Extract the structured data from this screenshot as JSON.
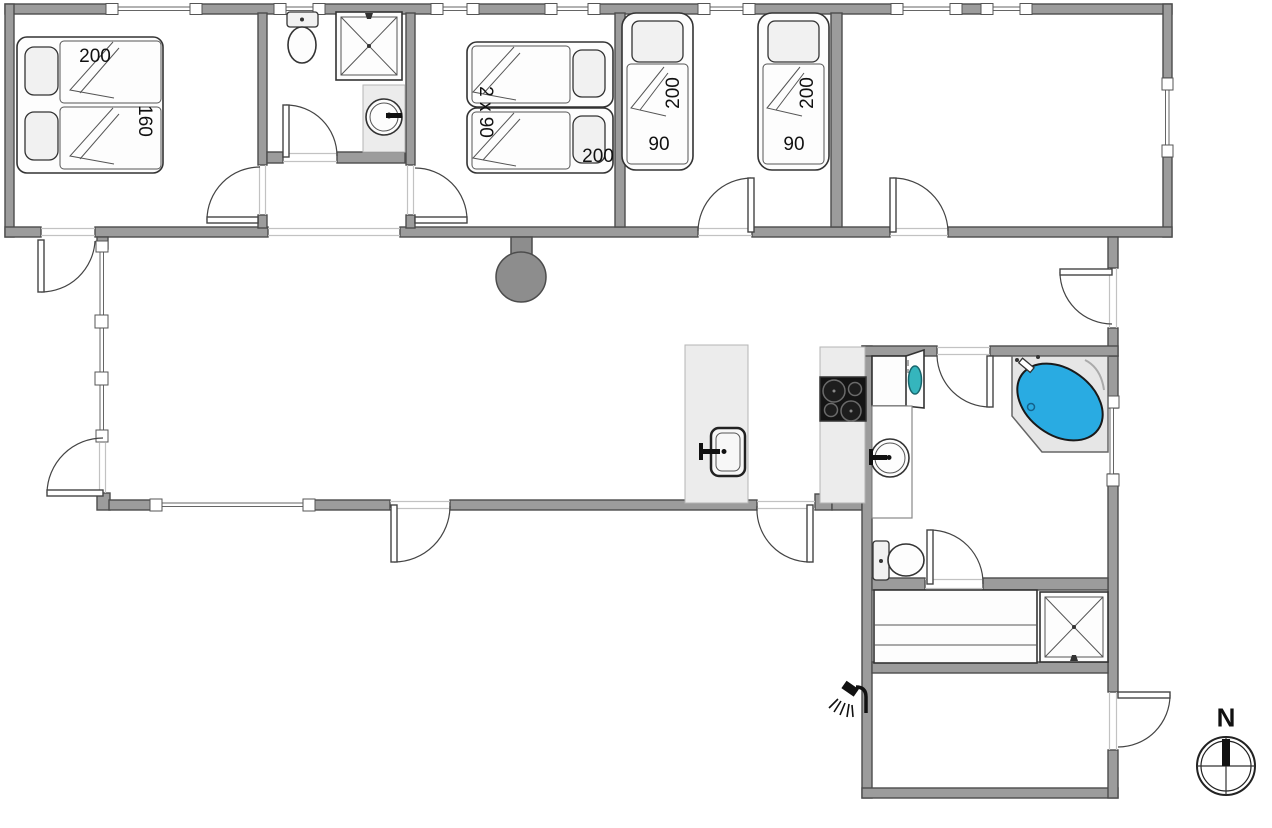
{
  "plan": {
    "type": "holiday-house-floor-plan",
    "labels": {
      "bed_double_length": "200",
      "bed_double_width": "160",
      "bed_twin_type": "2 x 90",
      "bed_twin_length": "200",
      "single_bed_a_length": "200",
      "single_bed_a_width": "90",
      "single_bed_b_length": "200",
      "single_bed_b_width": "90",
      "compass_north": "N"
    },
    "colors": {
      "wall": "#9c9c9c",
      "wall_outline": "#4c4c4c",
      "bathtub": "#29abe2",
      "washer_door": "#35b5bd",
      "fireplace": "#8d8d8d",
      "cooktop": "#141414",
      "counter": "#ececec"
    },
    "fixtures": [
      "double-bed",
      "twin-beds",
      "single-bed",
      "single-bed",
      "toilet",
      "shower-cabin",
      "washbasin",
      "kitchen-island-sink",
      "cooktop",
      "washing-machine",
      "corner-bathtub",
      "toilet",
      "sauna-bench",
      "shower-cabin",
      "fireplace",
      "outdoor-shower",
      "compass"
    ]
  }
}
